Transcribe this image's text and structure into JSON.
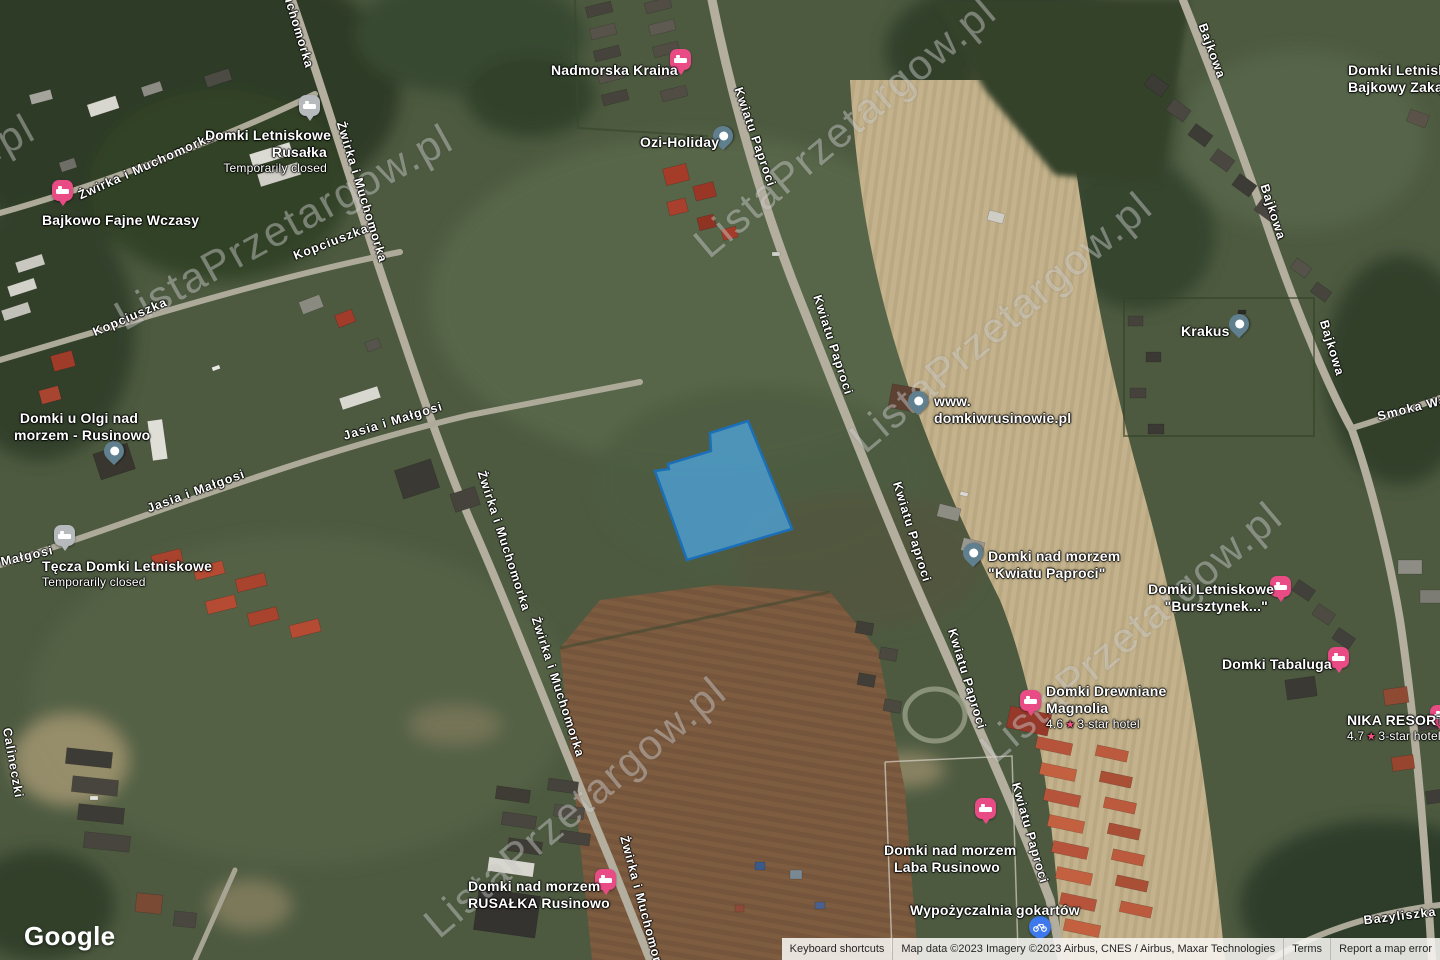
{
  "watermark": {
    "text": "ListaPrzetargow.pl"
  },
  "google_logo": "Google",
  "parcel": {
    "points": [
      [
        748,
        421
      ],
      [
        710,
        433
      ],
      [
        711,
        451
      ],
      [
        668,
        464
      ],
      [
        669,
        469
      ],
      [
        655,
        471
      ],
      [
        687,
        560
      ],
      [
        792,
        529
      ]
    ],
    "fill": "#4da9e8",
    "stroke": "#1b6fb8"
  },
  "colors": {
    "pin_pink": "#e94b85",
    "pin_slate": "#60808f",
    "pin_gray": "#b6babd",
    "pin_blue": "#3d79ec",
    "rating_star": "#f3527f"
  },
  "pois": [
    {
      "name": "nadmorska-kraina",
      "lines": [
        "Nadmorska Kraina"
      ],
      "pin": "lodging-pink"
    },
    {
      "name": "ozi-holiday",
      "lines": [
        "Ozi-Holiday"
      ],
      "pin": "generic-slate"
    },
    {
      "name": "domki-letniskowe-rusalka",
      "lines": [
        "Domki Letniskowe",
        "Rusałka"
      ],
      "status": "Temporarily closed",
      "pin": "lodging-gray"
    },
    {
      "name": "bajkowo-fajne-wczasy",
      "lines": [
        "Bajkowo Fajne Wczasy"
      ],
      "pin": "lodging-pink"
    },
    {
      "name": "domki-u-olgi",
      "lines": [
        "Domki u Olgi nad",
        "morzem - Rusinowo"
      ],
      "pin": "generic-slate"
    },
    {
      "name": "tecza-domki-letniskowe",
      "lines": [
        "Tęcza Domki Letniskowe"
      ],
      "status": "Temporarily closed",
      "pin": "lodging-gray"
    },
    {
      "name": "domkiwrusinowie",
      "lines": [
        "www.",
        "domkiwrusinowie.pl"
      ],
      "pin": "generic-slate"
    },
    {
      "name": "krakus",
      "lines": [
        "Krakus"
      ],
      "pin": "generic-slate"
    },
    {
      "name": "domki-kwiatu-paproci",
      "lines": [
        "Domki nad morzem",
        "\"Kwiatu Paproci\""
      ],
      "pin": "generic-slate"
    },
    {
      "name": "bursztynek",
      "lines": [
        "Domki Letniskowe",
        "\"Bursztynek...\""
      ],
      "pin": "lodging-pink"
    },
    {
      "name": "domki-tabaluga",
      "lines": [
        "Domki Tabaluga"
      ],
      "pin": "lodging-pink"
    },
    {
      "name": "domki-drewniane-magnolia",
      "lines": [
        "Domki Drewniane",
        "Magnolia"
      ],
      "rating": "4.6",
      "category": "3-star hotel",
      "pin": "lodging-pink"
    },
    {
      "name": "nika-resort",
      "lines": [
        "NIKA RESORT"
      ],
      "rating": "4.7",
      "category": "3-star hotel",
      "pin": "lodging-pink"
    },
    {
      "name": "laba-rusinowo",
      "lines": [
        "Domki nad morzem",
        "Laba Rusinowo"
      ],
      "pin": "lodging-pink"
    },
    {
      "name": "wypozyczalnia-gokartow",
      "lines": [
        "Wypożyczalnia gokartów"
      ],
      "pin": "gokart-blue"
    },
    {
      "name": "rusalka-rusinowo",
      "lines": [
        "Domki nad morzem",
        "RUSAŁKA Rusinowo"
      ],
      "pin": "lodging-pink"
    },
    {
      "name": "bajkowy-zakatek",
      "lines": [
        "Domki Letniskowe",
        "Bajkowy Zakątek"
      ]
    }
  ],
  "streets": [
    {
      "text": "Żwirka i Muchomorka"
    },
    {
      "text": "Żwirka i Muchomorka"
    },
    {
      "text": "Muchomorka"
    },
    {
      "text": "Żwirka i Muchomorka"
    },
    {
      "text": "Żwirka i Muchomorka"
    },
    {
      "text": "Żwirka i Muchomorka"
    },
    {
      "text": "Kopciuszka"
    },
    {
      "text": "Kopciuszka"
    },
    {
      "text": "Jasia i Małgosi"
    },
    {
      "text": "Jasia i Małgosi"
    },
    {
      "text": "Małgosi"
    },
    {
      "text": "Calineczki"
    },
    {
      "text": "Kwiatu Paproci"
    },
    {
      "text": "Kwiatu Paproci"
    },
    {
      "text": "Kwiatu Paproci"
    },
    {
      "text": "Kwiatu Paproci"
    },
    {
      "text": "Kwiatu Paproci"
    },
    {
      "text": "Bajkowa"
    },
    {
      "text": "Bajkowa"
    },
    {
      "text": "Bajkowa"
    },
    {
      "text": "Smoka Wa"
    },
    {
      "text": "Bazyliszka"
    }
  ],
  "footer": {
    "keyboard": "Keyboard shortcuts",
    "attribution": "Map data ©2023  Imagery ©2023 Airbus, CNES / Airbus, Maxar Technologies",
    "terms": "Terms",
    "report": "Report a map error"
  }
}
